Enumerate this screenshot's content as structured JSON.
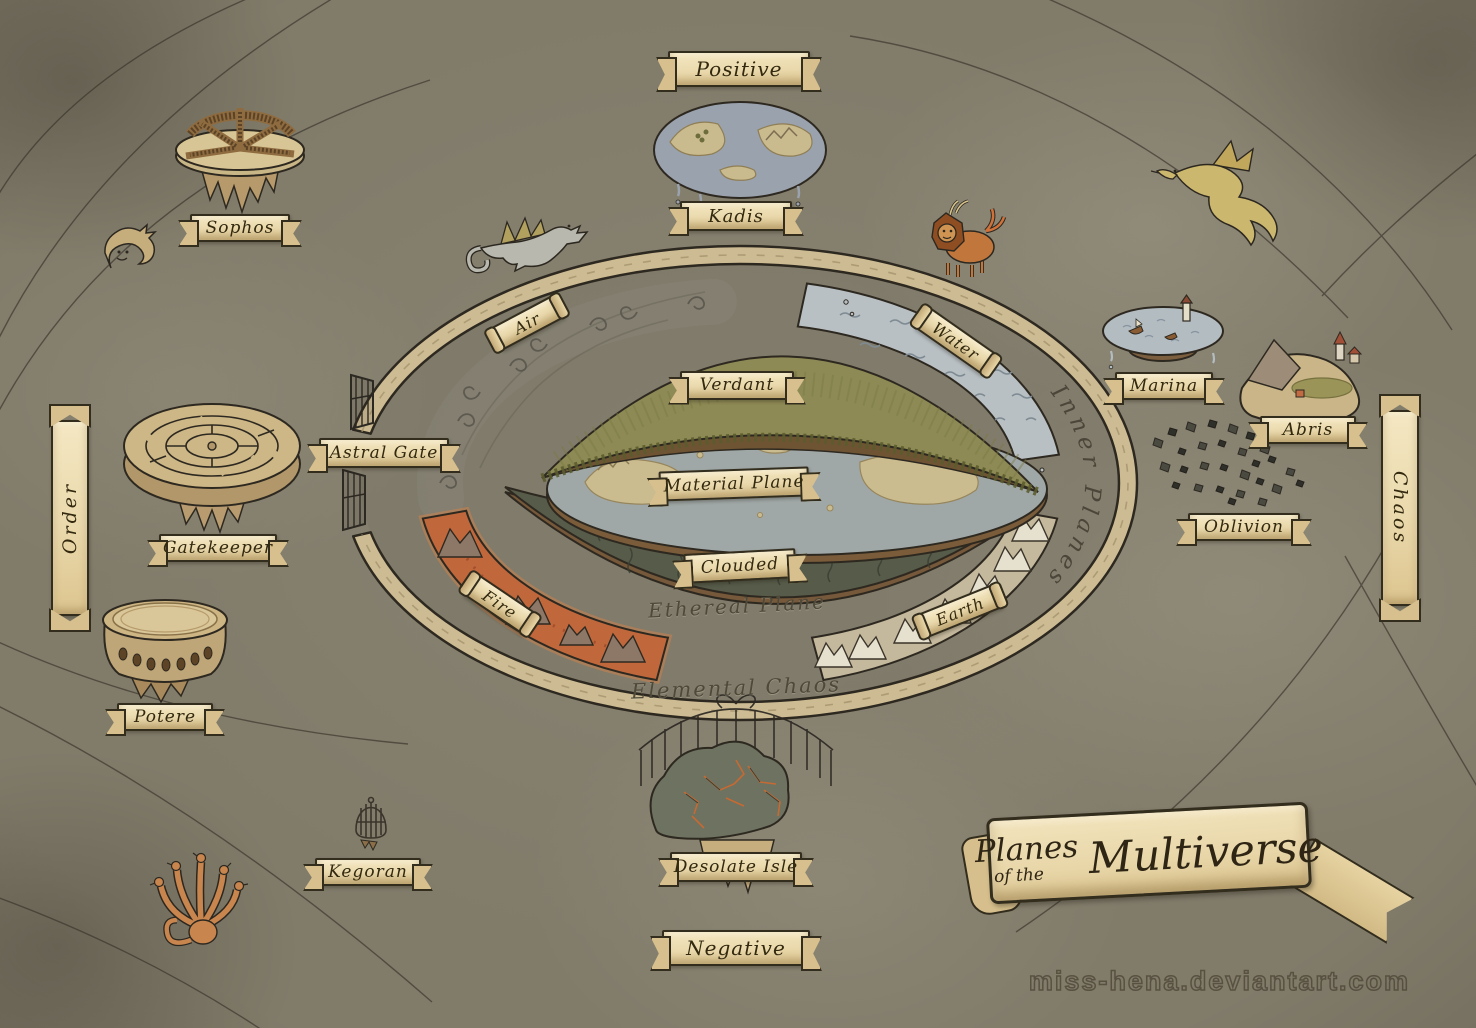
{
  "map": {
    "title": {
      "word1": "Planes",
      "word2": "of the",
      "word3": "Multiverse"
    },
    "watermark": "miss-hena.deviantart.com",
    "energy_poles": {
      "top": "Positive",
      "bottom": "Negative"
    },
    "alignment_poles": {
      "left": "Order",
      "right": "Chaos"
    },
    "ring_labels": {
      "astral_gate": "Astral Gate",
      "inner_planes": "Inner Planes",
      "ethereal_plane": "Ethereal Plane",
      "elemental_chaos": "Elemental Chaos"
    },
    "elemental_planes": {
      "air": "Air",
      "water": "Water",
      "earth": "Earth",
      "fire": "Fire"
    },
    "central_planes": {
      "verdant": "Verdant",
      "material": "Material Plane",
      "clouded": "Clouded"
    },
    "outer_planes": {
      "sophos": "Sophos",
      "kadis": "Kadis",
      "marina": "Marina",
      "abris": "Abris",
      "oblivion": "Oblivion",
      "gatekeeper": "Gatekeeper",
      "potere": "Potere",
      "kegoran": "Kegoran",
      "desolate_isle": "Desolate Isle"
    },
    "creatures": [
      {
        "name": "sea-serpent",
        "location": "upper-left"
      },
      {
        "name": "silver-dragon",
        "location": "top-center"
      },
      {
        "name": "manticore",
        "location": "top-right-of-ring"
      },
      {
        "name": "gold-dragon",
        "location": "far-upper-right"
      },
      {
        "name": "hydra",
        "location": "lower-left"
      }
    ],
    "colors": {
      "background": "#817b6a",
      "parchment": "#ecdcb0",
      "ink": "#332b1a",
      "astral_ring": "#cdbc93",
      "air": "#8a867a",
      "water": "#b9c0c4",
      "earth": "#c4b89d",
      "fire": "#c0683c",
      "verdant": "#8e8a55",
      "material": "#a0a8a7",
      "clouded": "#575b4a",
      "rock": "#7c5f3e",
      "lava_glow": "#d4824a"
    }
  }
}
